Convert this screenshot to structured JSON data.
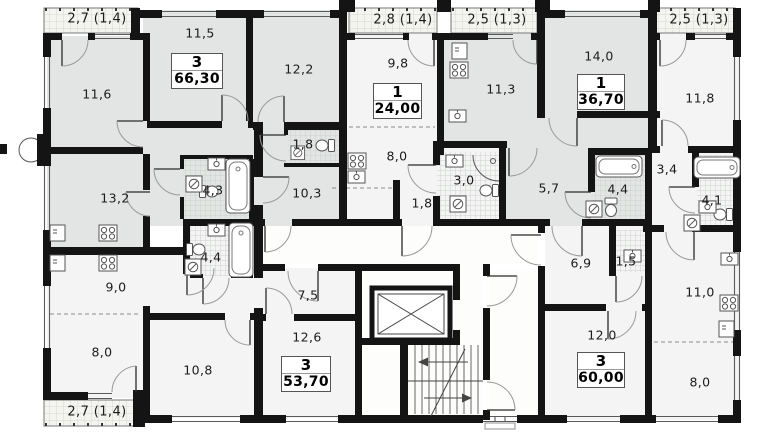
{
  "palette": {
    "wall": "#141414",
    "room_gray": "#e3e5e4",
    "room_light": "#f3f4f3",
    "corridor": "#fdfdfc",
    "balcony": "#f4f4f0",
    "line": "#8a8a8a",
    "text": "#1c1c1c"
  },
  "plan": {
    "apartments": [
      {
        "rooms": "3",
        "area": "66,30"
      },
      {
        "rooms": "1",
        "area": "24,00"
      },
      {
        "rooms": "1",
        "area": "36,70"
      },
      {
        "rooms": "3",
        "area": "53,70"
      },
      {
        "rooms": "3",
        "area": "60,00"
      }
    ],
    "room_labels": [
      "11,6",
      "11,5",
      "12,2",
      "13,2",
      "4,3",
      "1,8",
      "10,3",
      "9,8",
      "8,0",
      "1,8",
      "3,0",
      "11,3",
      "14,0",
      "5,7",
      "4,4",
      "11,8",
      "3,4",
      "4,1",
      "9,0",
      "8,0",
      "10,8",
      "7,5",
      "12,6",
      "4,4",
      "6,9",
      "1,5",
      "11,0",
      "12,0",
      "8,0"
    ],
    "balcony_labels": [
      "2,7 (1,4)",
      "2,8 (1,4)",
      "2,5 (1,3)",
      "2,5 (1,3)",
      "2,7 (1,4)"
    ]
  }
}
